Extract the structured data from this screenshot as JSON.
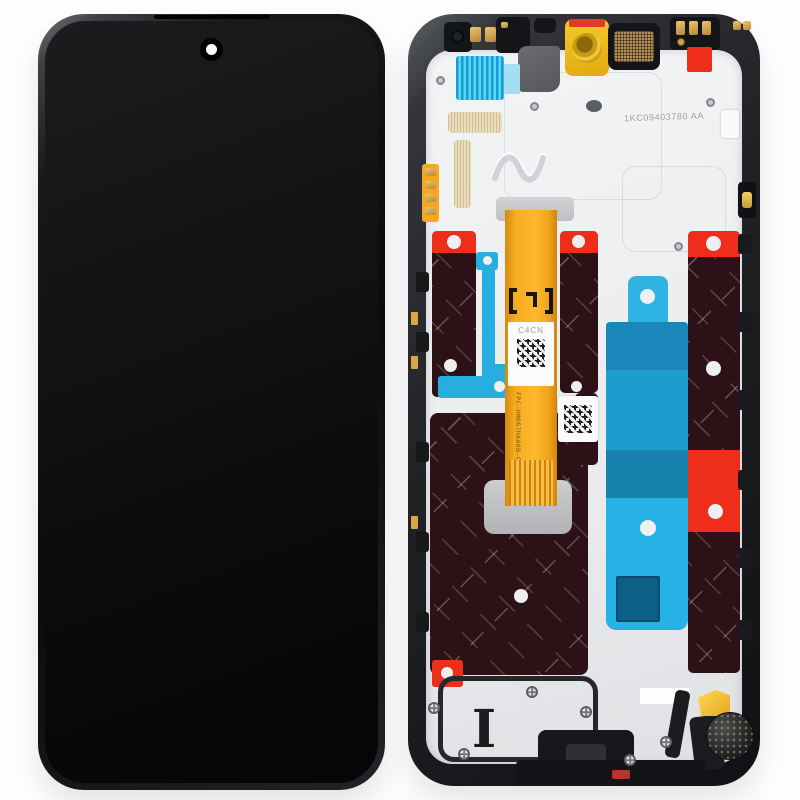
{
  "colors": {
    "background": "#fefefe",
    "frame_dark": "#141518",
    "frame_mid": "#3a3d42",
    "frame_light": "#6a6d72",
    "plate": "#ebedee",
    "graphite": "#2c1116",
    "red_sticker": "#ee2d1b",
    "cyan": "#27aede",
    "cyan_dark": "#1781ad",
    "cyan_mid": "#1b86ba",
    "cyan_light": "#a5def2",
    "flex_orange": "#f5a81f",
    "flash_yellow": "#f2c026",
    "gold": "#d8ab4e",
    "mesh_bronze": "#b2905c",
    "screen_black": "#0a0a0c"
  },
  "back_view": {
    "flex_label_code": "C4CN",
    "flex_part_number": "FPC-HM067HAA0B-C",
    "flex_lot_code": "LJ 2448",
    "etched_serial": "1KC09403780 AA",
    "bottom_mark": "I"
  }
}
